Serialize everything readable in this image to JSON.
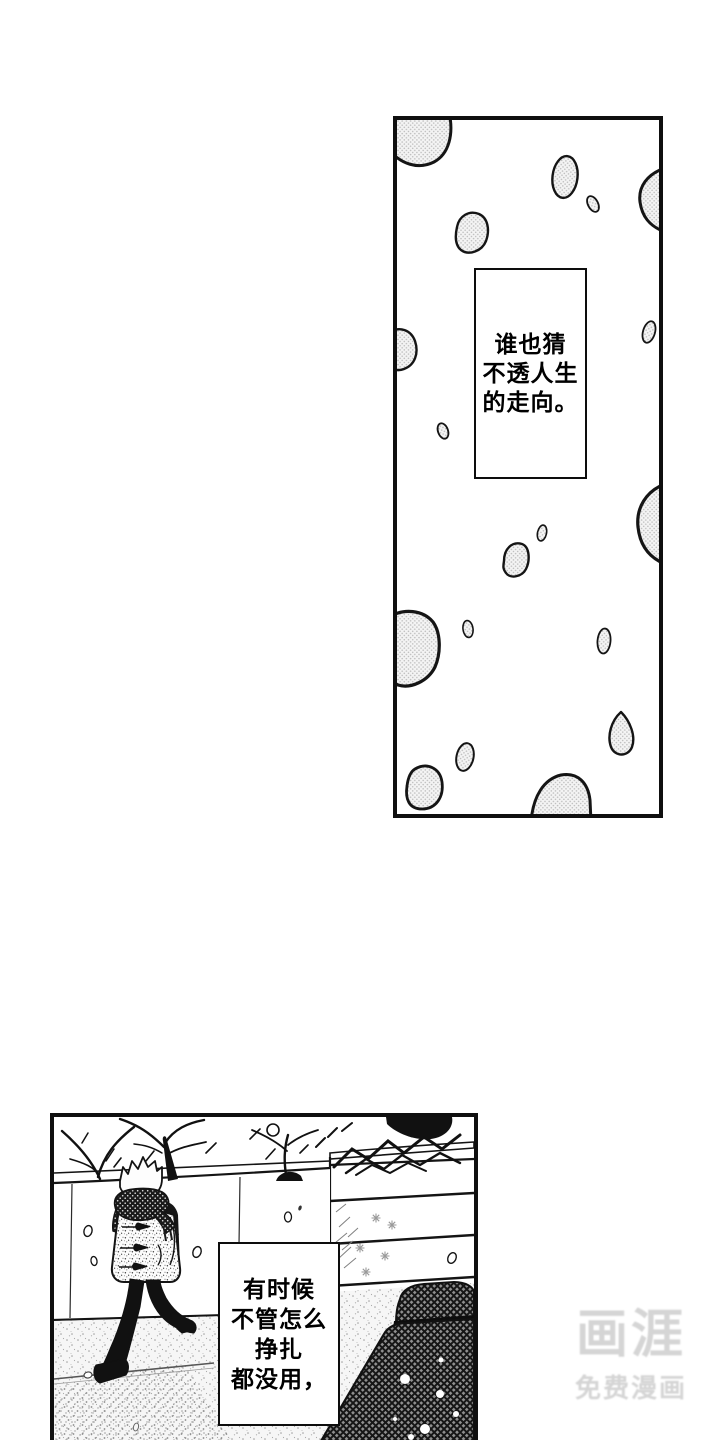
{
  "page": {
    "bg_color": "#ffffff",
    "ink_color": "#111111",
    "tone_color": "#bdbdbd"
  },
  "panels": [
    {
      "id": "snow-panel",
      "caption": {
        "full_text": "谁也猜不透人生的走向。",
        "lines": [
          "谁也猜",
          "不透人生",
          "的走向。"
        ]
      }
    },
    {
      "id": "street-panel",
      "caption": {
        "full_text": "有时候不管怎么挣扎都没用，",
        "lines": [
          "有时候",
          "不管怎么",
          "挣扎",
          "都没用，"
        ]
      }
    }
  ],
  "watermark": {
    "title": "画涯",
    "subtitle": "免费漫画",
    "color": "#d5d5d5"
  }
}
